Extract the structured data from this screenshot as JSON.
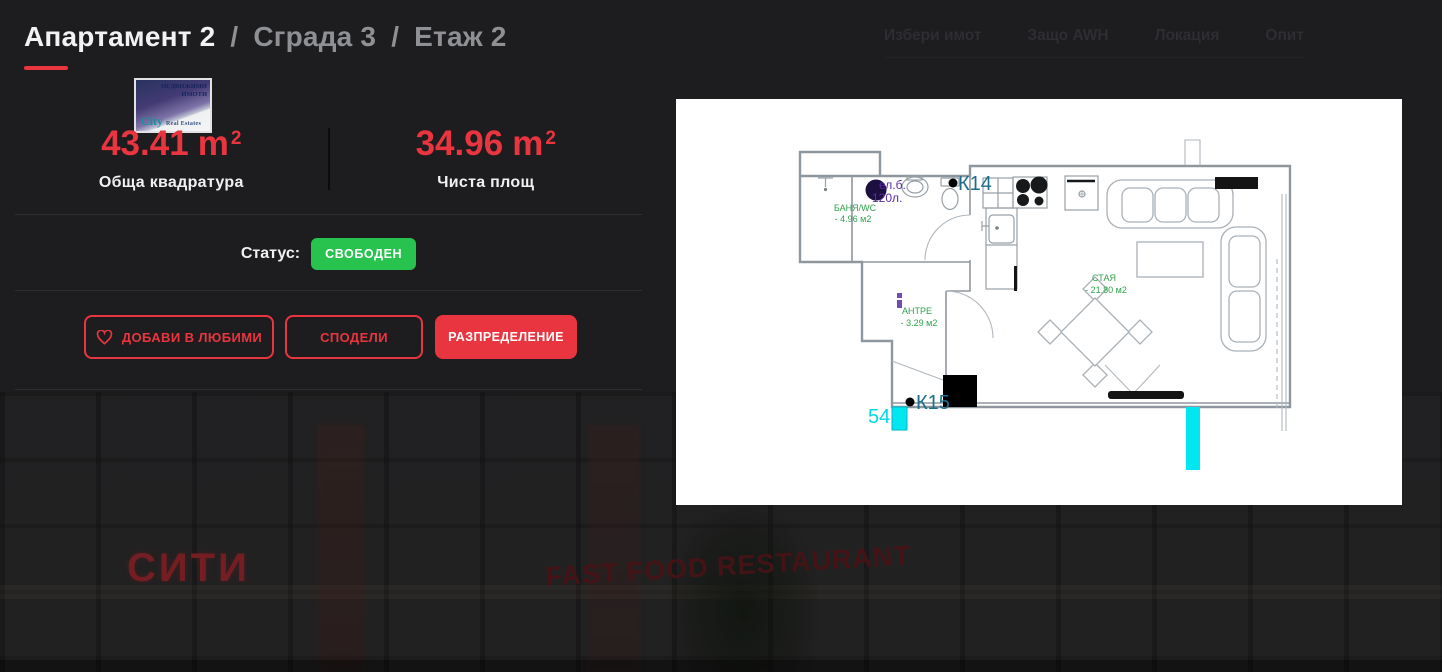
{
  "header": {
    "title": {
      "primary": "Апартамент 2",
      "separator": "/",
      "building": "Сграда 3",
      "floor": "Етаж 2"
    },
    "nav": {
      "items": [
        "Избери имот",
        "Защо AWH",
        "Локация",
        "Опит"
      ]
    }
  },
  "logo": {
    "top_line1": "НЕДВИЖИМИ",
    "top_line2": "ИМОТИ",
    "brand": "City",
    "brand_suffix": "Real Estates"
  },
  "stats": [
    {
      "value": "43.41",
      "unit": "m",
      "unit_power": "2",
      "label": "Обща квадратура"
    },
    {
      "value": "34.96",
      "unit": "m",
      "unit_power": "2",
      "label": "Чиста площ"
    }
  ],
  "status": {
    "label": "Статус:",
    "value": "СВОБОДЕН"
  },
  "actions": {
    "favorite": "ДОБАВИ В ЛЮБИМИ",
    "share": "СПОДЕЛИ",
    "layout": "РАЗПРЕДЕЛЕНИЕ"
  },
  "floorplan": {
    "rooms": [
      {
        "name": "БАНЯ/WC",
        "area": "- 4.96 м2"
      },
      {
        "name": "АНТРЕ",
        "area": "- 3.29 м2"
      },
      {
        "name": "СТАЯ",
        "area": "- 21.80 м2"
      }
    ],
    "markers": {
      "k14": "К14",
      "k15": "К15",
      "outlet": "54"
    },
    "boiler": {
      "line1": "ел.б.",
      "line2": "120л."
    }
  },
  "background": {
    "sign_left": "СИТИ",
    "sign_right": "FAST FOOD RESTAURANT"
  },
  "colors": {
    "accent": "#e9353f",
    "status_green": "#28c24f",
    "plan_green": "#2fa24a",
    "plan_teal": "#1d6e8c",
    "plan_cyan": "#00e7f2",
    "plan_purple": "#5c2ba6"
  }
}
